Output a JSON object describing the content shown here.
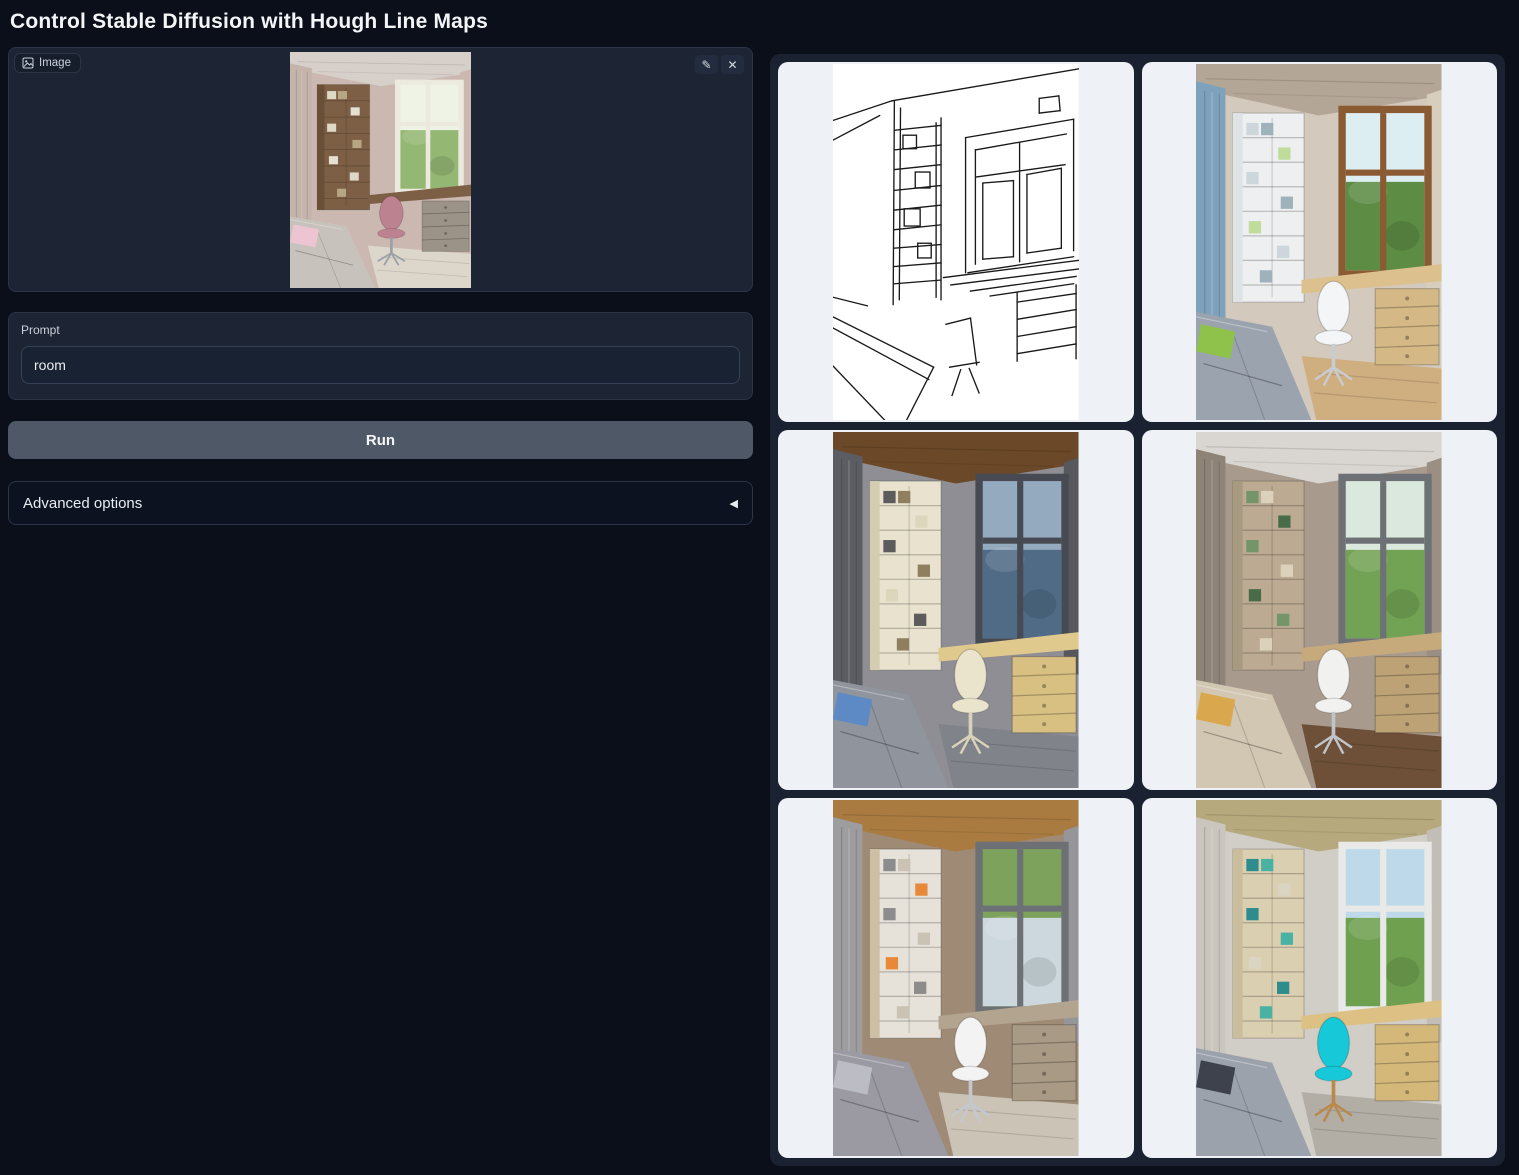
{
  "page": {
    "title": "Control Stable Diffusion with Hough Line Maps"
  },
  "theme": {
    "page_bg": "#0a0f1a",
    "panel_bg": "#1d2433",
    "panel_border": "#2b3547",
    "input_bg": "#192232",
    "run_button_bg": "#4e5866",
    "gallery_bg": "#1a2231",
    "card_bg": "#eef1f5",
    "title_color": "#f4f5f7"
  },
  "input_panel": {
    "label": "Image",
    "edit_glyph": "✎",
    "clear_glyph": "✕",
    "image_alt": "Uploaded room photo: pink-beige bedroom with wooden bookshelf, desk under the window, pink office chair and gray bed",
    "scene": {
      "palette": {
        "wall": "#cbb9b1",
        "ceiling": "#d7cfc9",
        "curtainL": "#c4b4ab",
        "curtainR": "#cbb9b1",
        "shelf": "#7d5f45",
        "shelfSide": "#6a4f38",
        "books": [
          "#ded8c6",
          "#b8a584",
          "#e6e0d2"
        ],
        "frame": "#eceadf",
        "viewTop": "#eef3e6",
        "viewBottom": "#94b873",
        "desk": "#7d5f45",
        "drawer": "#9b9288",
        "floor": "#ddd6ca",
        "bed": "#c7c3bc",
        "pillow": "#ecc4d2",
        "chair": "#bd8290",
        "chairBase": "#9aa0a8"
      }
    }
  },
  "prompt": {
    "label": "Prompt",
    "value": "room"
  },
  "run_button": {
    "label": "Run"
  },
  "advanced_options": {
    "label": "Advanced options",
    "arrow_glyph": "◀",
    "state": "collapsed"
  },
  "gallery": {
    "items": [
      {
        "id": 1,
        "type": "linemap",
        "alt": "Hough line map (MLSD) detected from the input room photo: black line drawing of bookshelf, window, desk and bed on white"
      },
      {
        "id": 2,
        "type": "photo",
        "alt": "Generated room: white shelving, blue curtains, wooden window with green view, gray bed with green pillow, white desk chair",
        "palette": {
          "wall": "#d3cabd",
          "ceiling": "#b4a697",
          "curtainL": "#7fa2bc",
          "curtainR": "#d8cebe",
          "shelf": "#edeff0",
          "shelfSide": "#dfe3e6",
          "books": [
            "#cdd6da",
            "#9fb2bb",
            "#c0dc9a"
          ],
          "frame": "#8a5a33",
          "viewTop": "#ddeef2",
          "viewBottom": "#5d8c45",
          "desk": "#dcc08e",
          "drawer": "#d4b886",
          "floor": "#cfae80",
          "bed": "#9ba3af",
          "pillow": "#8fc24a",
          "chair": "#f3f5f6",
          "chairBase": "#c8ccd2"
        }
      },
      {
        "id": 3,
        "type": "photo",
        "alt": "Generated room at dusk: dark wood ceiling, gray curtains, cream shelving and chair, blue pillow on gray bed, lit wooden drawers",
        "palette": {
          "wall": "#8e8e94",
          "ceiling": "#6b4827",
          "curtainL": "#5b5d62",
          "curtainR": "#56585d",
          "shelf": "#e8e2ce",
          "shelfSide": "#d4cdb2",
          "books": [
            "#5c5c5c",
            "#8f7f5f",
            "#dcd6bc"
          ],
          "frame": "#474a52",
          "viewTop": "#93aabf",
          "viewBottom": "#4f6b86",
          "desk": "#e0c98c",
          "drawer": "#d8bf82",
          "floor": "#808389",
          "bed": "#8f949d",
          "pillow": "#5d8ac4",
          "chair": "#eae4cc",
          "chairBase": "#d8d2ba"
        }
      },
      {
        "id": 4,
        "type": "photo",
        "alt": "Generated room: taupe walls, green tree view, beige bed with yellow pillow, white chair, dark wood floor",
        "palette": {
          "wall": "#a89b8d",
          "ceiling": "#d9d6d1",
          "curtainL": "#8e8377",
          "curtainR": "#9a8f82",
          "shelf": "#bcab92",
          "shelfSide": "#a89a80",
          "books": [
            "#74946a",
            "#dcd2bc",
            "#486c48"
          ],
          "frame": "#6d7075",
          "viewTop": "#dbe8dd",
          "viewBottom": "#72a254",
          "desk": "#c6aa7c",
          "drawer": "#bda276",
          "floor": "#6d5037",
          "bed": "#d2c7b2",
          "pillow": "#d9a84e",
          "chair": "#f1f1ef",
          "chairBase": "#c0c4ca"
        }
      },
      {
        "id": 5,
        "type": "photo",
        "alt": "Generated room: warm wood ceiling, gray curtains, white shelving with orange book, greenery at top of window, patterned gray bed, white chair",
        "palette": {
          "wall": "#9f8a75",
          "ceiling": "#a97b40",
          "curtainL": "#9d9d9f",
          "curtainR": "#96969a",
          "shelf": "#e6e2da",
          "shelfSide": "#cdbfa4",
          "books": [
            "#8c8c8c",
            "#cac2b2",
            "#e8893a"
          ],
          "frame": "#6d7176",
          "viewTop": "#7ca25c",
          "viewBottom": "#ccd8de",
          "desk": "#b2a48e",
          "drawer": "#a89a84",
          "floor": "#cbc4b6",
          "bed": "#9b9aa3",
          "pillow": "#bcbcc4",
          "chair": "#f3f3f3",
          "chairBase": "#c4c8ce"
        }
      },
      {
        "id": 6,
        "type": "photo",
        "alt": "Generated room: plywood ceiling, bright white window with blue sky and trees, pale wood shelving with teal books, gray bed with dark pillow, turquoise chair",
        "palette": {
          "wall": "#d1cec8",
          "ceiling": "#b6a97d",
          "curtainL": "#cac6be",
          "curtainR": "#c2beb6",
          "shelf": "#dbcfb2",
          "shelfSide": "#c9bd9e",
          "books": [
            "#2f8c8c",
            "#4ab2a2",
            "#dad4c2"
          ],
          "frame": "#e9e9e7",
          "viewTop": "#bedaea",
          "viewBottom": "#6fa050",
          "desk": "#dcc084",
          "drawer": "#d4b87a",
          "floor": "#b2aea6",
          "bed": "#9ca2ac",
          "pillow": "#3d424d",
          "chair": "#17c8d8",
          "chairBase": "#b8894a"
        }
      }
    ]
  }
}
